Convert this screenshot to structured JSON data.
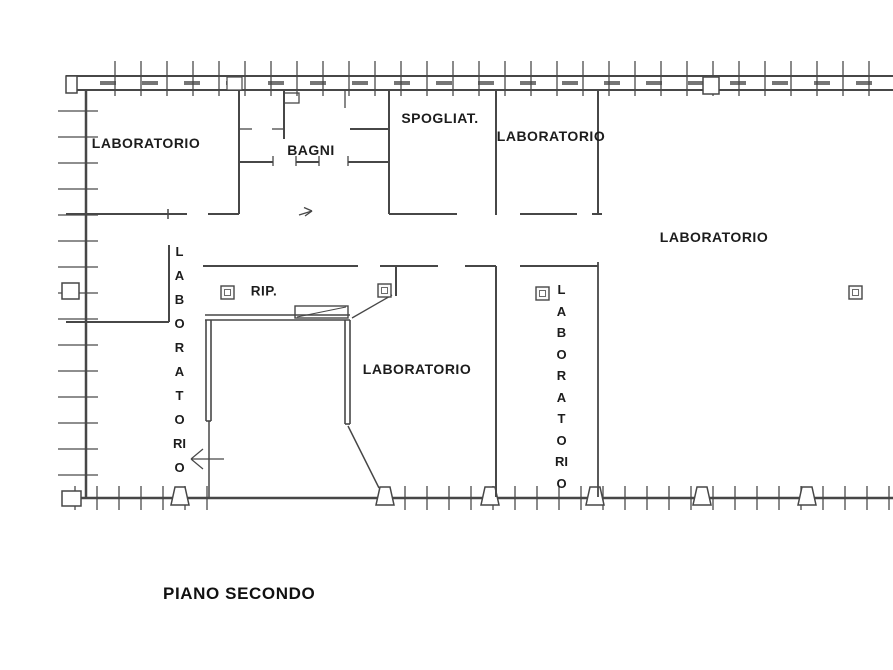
{
  "plan": {
    "title": "PIANO SECONDO",
    "labels": {
      "lab_top_left": "LABORATORIO",
      "bagni": "BAGNI",
      "spogliatoio": "SPOGLIAT.",
      "lab_top_center": "LABORATORIO",
      "lab_right": "LABORATORIO",
      "rip": "RIP.",
      "lab_left_vertical": "LABORATORIO",
      "lab_center": "LABORATORIO",
      "lab_right_vertical": "LABORATORIO"
    },
    "colors": {
      "line": "#474747",
      "text": "#1c1c1c",
      "background": "#ffffff"
    }
  }
}
